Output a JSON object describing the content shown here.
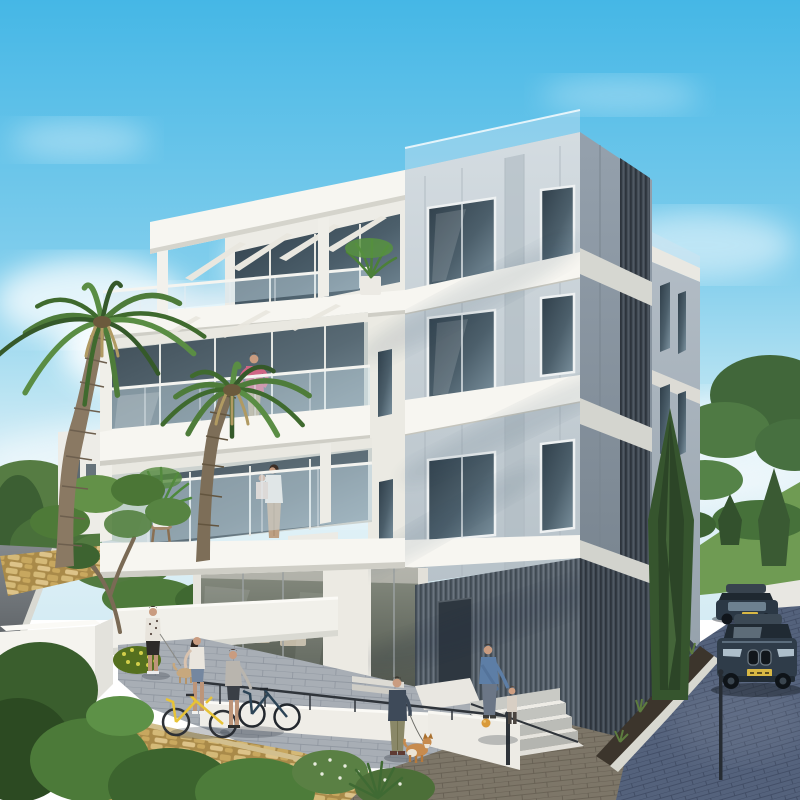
{
  "meta": {
    "title": "3D architectural rendering of a modern four-storey apartment building on a sunny day"
  },
  "scene": {
    "sky": "clear blue sky fading to pale horizon with soft white clouds",
    "building": {
      "storeys": 4,
      "style": "contemporary white and grey stone-panel residence",
      "features": [
        "rooftop pergola over top terrace",
        "stacked balconies with frameless glass railings",
        "grey concrete panel facade with large windows",
        "dark vertical louvre cladding on ground floor",
        "glass lobby entrance with lounge seating",
        "roof-edge glass balustrade",
        "narrow windows on rear wing"
      ]
    },
    "people": [
      {
        "label": "man in pink shirt standing on third-floor balcony"
      },
      {
        "label": "woman holding a child on second-floor balcony"
      },
      {
        "label": "man in patterned shirt walking a small dog on upper path"
      },
      {
        "label": "woman astride a yellow bicycle on the walkway"
      },
      {
        "label": "man standing with a dark bicycle"
      },
      {
        "label": "man in navy jacket walking a corgi near the entrance"
      },
      {
        "label": "man helping a toddler down the entrance stairs"
      }
    ],
    "vehicles": [
      {
        "label": "dark SUV parked up the driveway"
      },
      {
        "label": "dark SUV with yellow licence plate parked closer"
      }
    ],
    "vegetation": [
      "two tall fan palms on the left",
      "branching frangipani tree by the white wall",
      "potted plants on the balconies",
      "tall cypress beside the building",
      "pines and lawn hills on the right",
      "shrubs, yellow-flower bush and yucca in the foreground garden"
    ],
    "hardscape": [
      "asphalt road upper left",
      "yellow stone retaining walls",
      "white garden walls",
      "paver walkway with metal handrail",
      "white access ramp",
      "entrance stairs",
      "brick plaza",
      "blue-grey brick driveway with white curb",
      "distant white house on the left"
    ]
  },
  "palette": {
    "sky_top": "#45b7e6",
    "sky_mid": "#9ad9f0",
    "sky_horizon": "#e3f2f8",
    "cloud": "#ffffff",
    "white_lit": "#f7f6f1",
    "white_shade": "#dddcd4",
    "concrete_lit": "#c9d2d8",
    "concrete_shadow": "#8d99a5",
    "louver_dark": "#454f59",
    "glass_dark": "#41515d",
    "glass_light": "#8ba3b2",
    "rail_glass": "#cfe4ef",
    "green_dark": "#2e4d26",
    "green_mid": "#4d7a39",
    "green_light": "#6ca24c",
    "palm_trunk": "#8a7963",
    "asphalt": "#686d72",
    "stone_yellow": "#c8a75e",
    "paver": "#a8aeb5",
    "brick": "#7d7668",
    "drive_brick": "#54627c",
    "car_body": "#2f3c49",
    "plate_yellow": "#d9b844",
    "skin": "#c99c80",
    "pink_shirt": "#cf6584",
    "blue_shirt": "#5d7ea6",
    "yellow_bike": "#e7c337"
  }
}
